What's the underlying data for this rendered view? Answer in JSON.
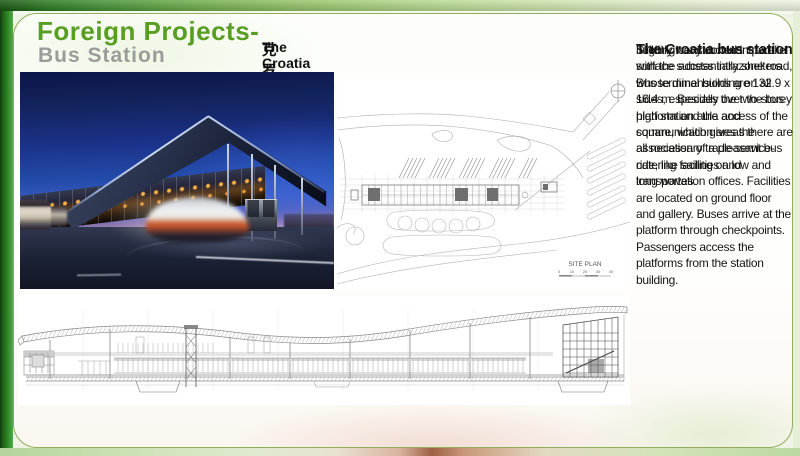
{
  "header": {
    "title": "Foreign Projects-",
    "subtitle": "Bus Station"
  },
  "caption": {
    "en": "The Croatia bus station",
    "zh": "克罗地亚公交车站"
  },
  "description": {
    "heading": "The Croatia bus station",
    "para1": "building constructed in parallel with the access intrazone road, whose dimensions are 132.9 x 16.4 m. Besides the two-storey high station aula and communication areas there are all necessary trade-service-catering facilities and transportation offices. Facilities are located on ground floor and gallery. Buses arrive at the platform through checkpoints. Passengers access the platforms from the station building.",
    "para2": "Slightly wavy dominant roof surface substantially shelters Bus terminal building on all sides, especially over the bus platform and the access of the square, which gives the association of a pleasant bus ride, like sailing on low and long waves."
  },
  "site_plan": {
    "label": "SITE PLAN",
    "ticks": [
      "0",
      "10",
      "20",
      "30",
      "40"
    ]
  },
  "colors": {
    "title_green": "#589e22",
    "subtitle_gray": "#9b9b9b",
    "panel_border": "#90ad5c",
    "header_bar_green": "#2f7d26",
    "photo_sky_blue": "#234baa",
    "photo_horizon_pink": "#e3bfc8",
    "canopy_light_orange": "#f09a32"
  }
}
